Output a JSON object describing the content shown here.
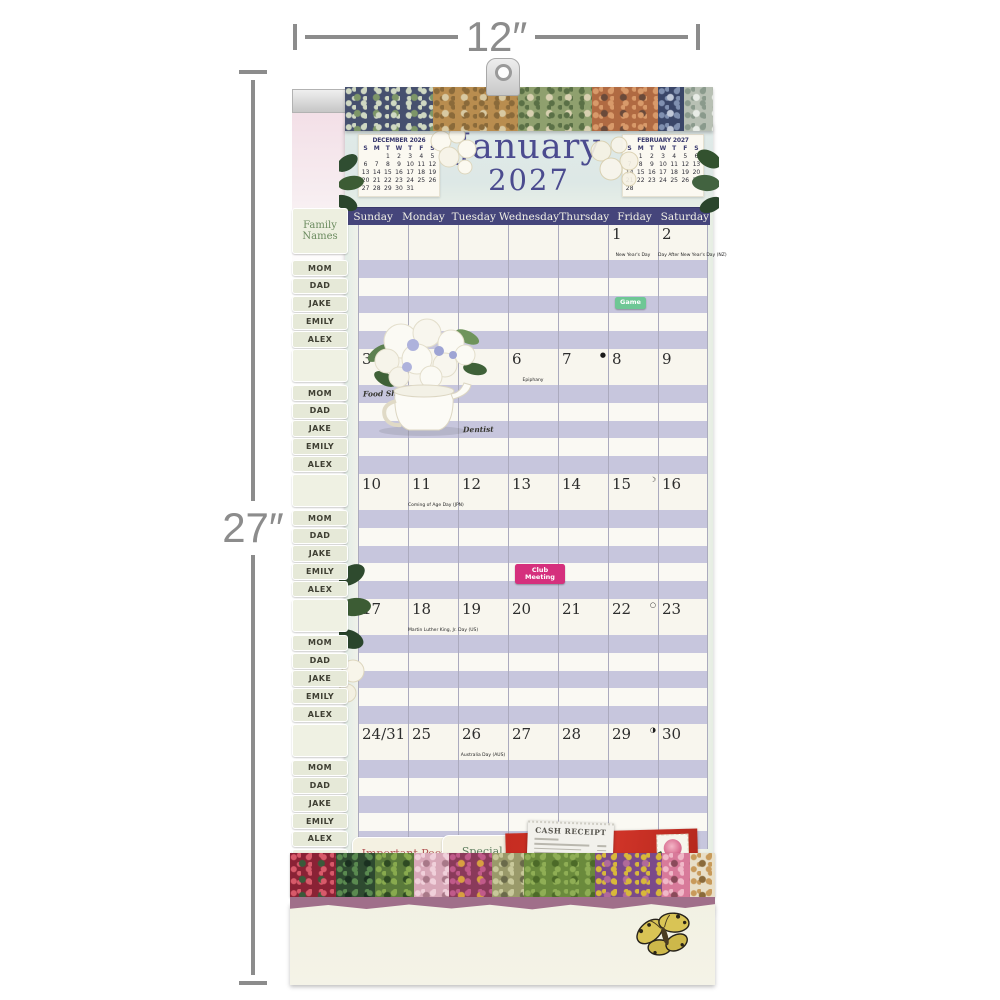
{
  "dimension_annotations": {
    "width": "12″",
    "height": "27″"
  },
  "calendar": {
    "month": "January",
    "year": "2027",
    "weekday_headers": [
      "Sunday",
      "Monday",
      "Tuesday",
      "Wednesday",
      "Thursday",
      "Friday",
      "Saturday"
    ],
    "mini_calendars": [
      {
        "title": "DECEMBER 2026",
        "day_row": [
          "S",
          "M",
          "T",
          "W",
          "T",
          "F",
          "S"
        ],
        "weeks": [
          [
            "",
            "",
            "1",
            "2",
            "3",
            "4",
            "5"
          ],
          [
            "6",
            "7",
            "8",
            "9",
            "10",
            "11",
            "12"
          ],
          [
            "13",
            "14",
            "15",
            "16",
            "17",
            "18",
            "19"
          ],
          [
            "20",
            "21",
            "22",
            "23",
            "24",
            "25",
            "26"
          ],
          [
            "27",
            "28",
            "29",
            "30",
            "31",
            "",
            ""
          ]
        ]
      },
      {
        "title": "FEBRUARY 2027",
        "day_row": [
          "S",
          "M",
          "T",
          "W",
          "T",
          "F",
          "S"
        ],
        "weeks": [
          [
            "",
            "1",
            "2",
            "3",
            "4",
            "5",
            "6"
          ],
          [
            "7",
            "8",
            "9",
            "10",
            "11",
            "12",
            "13"
          ],
          [
            "14",
            "15",
            "16",
            "17",
            "18",
            "19",
            "20"
          ],
          [
            "21",
            "22",
            "23",
            "24",
            "25",
            "26",
            "27"
          ],
          [
            "28",
            "",
            "",
            "",
            "",
            "",
            ""
          ]
        ]
      }
    ],
    "weeks": [
      {
        "dates": [
          "",
          "",
          "",
          "",
          "",
          "1",
          "2"
        ],
        "notes": [
          {
            "col": 5,
            "text": "New Year's Day"
          },
          {
            "col": 6,
            "text": "Day After New Year's Day (NZ)"
          }
        ],
        "stickers": [
          {
            "col": 5,
            "stripe": 2,
            "label": "Game",
            "color": "#6ec795"
          }
        ]
      },
      {
        "dates": [
          "3",
          "4",
          "5",
          "6",
          "7",
          "8",
          "9"
        ],
        "notes": [
          {
            "col": 3,
            "text": "Epiphany"
          }
        ],
        "moons": [
          {
            "col": 4,
            "symbol": "●"
          }
        ],
        "events": [
          {
            "col": 0,
            "stripe": 0,
            "text": "Food Shopping"
          },
          {
            "col": 2,
            "stripe": 2,
            "text": "Dentist"
          }
        ]
      },
      {
        "dates": [
          "10",
          "11",
          "12",
          "13",
          "14",
          "15",
          "16"
        ],
        "notes": [
          {
            "col": 1,
            "text": "Coming of Age Day (JPN)"
          }
        ],
        "moons": [
          {
            "col": 5,
            "symbol": "☽"
          }
        ],
        "stickers": [
          {
            "col": 3,
            "stripe": 3,
            "label": "Club Meeting",
            "color": "#d5307d"
          }
        ]
      },
      {
        "dates": [
          "17",
          "18",
          "19",
          "20",
          "21",
          "22",
          "23"
        ],
        "notes": [
          {
            "col": 1,
            "text": "Martin Luther King, Jr. Day (US)"
          }
        ],
        "moons": [
          {
            "col": 5,
            "symbol": "○"
          }
        ]
      },
      {
        "dates": [
          "24/31",
          "25",
          "26",
          "27",
          "28",
          "29",
          "30"
        ],
        "notes": [
          {
            "col": 2,
            "text": "Australia Day (AUS)"
          }
        ],
        "moons": [
          {
            "col": 5,
            "symbol": "◑"
          }
        ]
      }
    ]
  },
  "sidebar": {
    "header": "Family Names",
    "names": [
      "MOM",
      "DAD",
      "JAKE",
      "EMILY",
      "ALEX"
    ],
    "group_count": 5
  },
  "footer": {
    "pocket_tabs": [
      "Important People",
      "Special Dates"
    ],
    "receipt_title": "CASH RECEIPT"
  },
  "decor": {
    "stripe_lavender": "#c7c6dd",
    "weekbar_navy": "#45457b",
    "envelope_red": "#c62c21",
    "torn_edge_plum": "#a06f8a",
    "patchwork_top": [
      {
        "w": 24,
        "base": "#46506e",
        "dot": "#cfd8c2",
        "dot2": "#7d9668"
      },
      {
        "w": 23,
        "base": "#b98d4f",
        "dot": "#8a6a3a",
        "dot2": "#d8c9a2"
      },
      {
        "w": 20,
        "base": "#8fa06e",
        "dot": "#5a7046",
        "dot2": "#d8d0b0"
      },
      {
        "w": 18,
        "base": "#b06a42",
        "dot": "#d89a6a",
        "dot2": "#6a4a3a"
      },
      {
        "w": 7,
        "base": "#3a4668",
        "dot": "#8090b0",
        "dot2": "#c0c8d8"
      },
      {
        "w": 8,
        "base": "#b8c0b4",
        "dot": "#8a9a8c",
        "dot2": "#e8ece6"
      }
    ],
    "patchwork_bottom": [
      {
        "w": 13,
        "base": "#8a2235",
        "dot": "#d85a6a",
        "dot2": "#3a5a3a"
      },
      {
        "w": 11,
        "base": "#2e4a30",
        "dot": "#5a8a50",
        "dot2": "#1a3020"
      },
      {
        "w": 11,
        "base": "#5a7a3a",
        "dot": "#88aa4e",
        "dot2": "#2e4a22"
      },
      {
        "w": 10,
        "base": "#d8a8b8",
        "dot": "#f0d0da",
        "dot2": "#a87888"
      },
      {
        "w": 12,
        "base": "#8a3a5a",
        "dot": "#c05a8a",
        "dot2": "#d8a040"
      },
      {
        "w": 9,
        "base": "#9a9a6a",
        "dot": "#c8c89a",
        "dot2": "#6a6a4a"
      },
      {
        "w": 20,
        "base": "#6a8a3c",
        "dot": "#8fae55",
        "dot2": "#4c6a28"
      },
      {
        "w": 19,
        "base": "#7a4a8a",
        "dot": "#d8b83a",
        "dot2": "#b06a9a"
      },
      {
        "w": 8,
        "base": "#d87a9a",
        "dot": "#f0b8c8",
        "dot2": "#8a4a5a"
      },
      {
        "w": 7,
        "base": "#e8dfc8",
        "dot": "#c89a5a",
        "dot2": "#8a6a3a"
      }
    ]
  }
}
